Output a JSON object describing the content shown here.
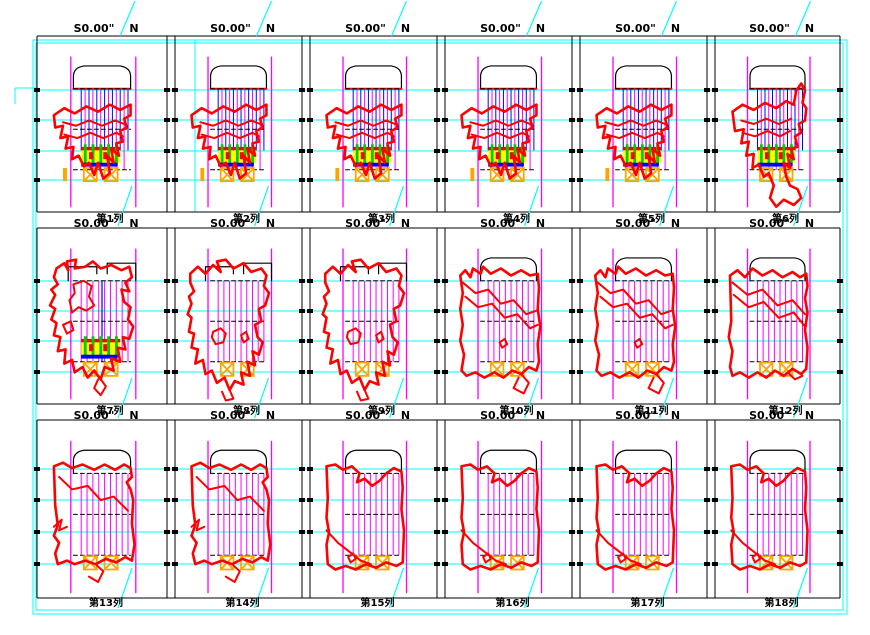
{
  "sheet": {
    "type": "CAD column section sheet",
    "rows": 3,
    "columns_per_row": 6
  },
  "labels": {
    "elevation_s": "S0.00\"",
    "elevation_n": "N",
    "col_labels": [
      "第1列",
      "第2列",
      "第3列",
      "第4列",
      "第5列",
      "第6列",
      "第7列",
      "第8列",
      "第9列",
      "第10列",
      "第11列",
      "第12列",
      "第13列",
      "第14列",
      "第15列",
      "第16列",
      "第17列",
      "第18列"
    ]
  },
  "colors": {
    "grid_cyan": "#00ffff",
    "guide_magenta": "#ff00ff",
    "hatch_blue": "#0000ff",
    "outline_red": "#ff0000",
    "support_green": "#00cc00",
    "support_yellow": "#ffff00",
    "support_blue": "#0000ff",
    "anchor_orange": "#ffa500",
    "frame_black": "#000000",
    "text_black": "#000000"
  },
  "panels": [
    {
      "id": 1,
      "shape": "A",
      "arch": "dome",
      "hatch": "blue-magenta",
      "cluster": true,
      "stub": true
    },
    {
      "id": 2,
      "shape": "A",
      "arch": "dome",
      "hatch": "blue-magenta",
      "cluster": true,
      "stub": true
    },
    {
      "id": 3,
      "shape": "A",
      "arch": "dome",
      "hatch": "blue-magenta",
      "cluster": true,
      "stub": true
    },
    {
      "id": 4,
      "shape": "A",
      "arch": "dome",
      "hatch": "blue-magenta",
      "cluster": true,
      "stub": true
    },
    {
      "id": 5,
      "shape": "A",
      "arch": "dome",
      "hatch": "blue-magenta",
      "cluster": true,
      "stub": true
    },
    {
      "id": 6,
      "shape": "B",
      "arch": "dome",
      "hatch": "blue-magenta",
      "cluster": true,
      "stub": false
    },
    {
      "id": 7,
      "shape": "C",
      "arch": "split",
      "hatch": "magenta-blue",
      "cluster": true,
      "stub": false
    },
    {
      "id": 8,
      "shape": "D",
      "arch": "split",
      "hatch": "magenta",
      "cluster": false,
      "stub": false
    },
    {
      "id": 9,
      "shape": "D",
      "arch": "split",
      "hatch": "magenta",
      "cluster": false,
      "stub": false
    },
    {
      "id": 10,
      "shape": "E",
      "arch": "dome",
      "hatch": "magenta",
      "cluster": false,
      "stub": false
    },
    {
      "id": 11,
      "shape": "E",
      "arch": "dome",
      "hatch": "magenta",
      "cluster": false,
      "stub": false
    },
    {
      "id": 12,
      "shape": "F",
      "arch": "dome",
      "hatch": "magenta",
      "cluster": false,
      "stub": false
    },
    {
      "id": 13,
      "shape": "G",
      "arch": "dome",
      "hatch": "magenta",
      "cluster": false,
      "stub": false
    },
    {
      "id": 14,
      "shape": "G",
      "arch": "dome",
      "hatch": "magenta",
      "cluster": false,
      "stub": false
    },
    {
      "id": 15,
      "shape": "H",
      "arch": "dome",
      "hatch": "magenta",
      "cluster": false,
      "stub": false
    },
    {
      "id": 16,
      "shape": "H",
      "arch": "dome",
      "hatch": "magenta",
      "cluster": false,
      "stub": false
    },
    {
      "id": 17,
      "shape": "H",
      "arch": "dome",
      "hatch": "magenta",
      "cluster": false,
      "stub": false
    },
    {
      "id": 18,
      "shape": "H",
      "arch": "dome",
      "hatch": "magenta",
      "cluster": false,
      "stub": false
    }
  ],
  "shapes": {
    "A": {
      "outer": "M13,45 L21,41 29,44 38,40 47,43 56,39 64,42 72,39 72,45 67,47 69,52 64,54 66,60 61,61 63,68 57,64 59,72 54,68 56,78 51,81 47,72 44,79 40,72 36,74 32,68 27,70 28,63 22,64 24,57 18,58 20,51 14,52 13,45 Z",
      "inner": [
        "M20,49 L30,51 40,48 50,51 60,48 67,50",
        "M21,56 L31,58 41,55 51,58 61,55 66,57"
      ]
    },
    "B": {
      "outer": "M14,43 L22,39 31,42 40,38 49,41 57,37 63,39 65,31 69,27 72,31 70,38 73,41 72,48 67,50 69,55 64,57 66,63 61,64 63,70 58,67 60,75 55,72 57,80 60,85 66,87 69,92 63,96 55,93 49,97 44,92 47,85 43,78 39,80 35,73 30,75 31,67 25,68 27,60 21,61 23,53 16,54 14,43 Z",
      "inner": [
        "M21,48 L31,50 41,47 51,50 61,47",
        "M22,55 L32,57 42,54 52,57 60,54"
      ]
    },
    "C": {
      "outer": "M15,23 L21,20 24,24 23,19 30,18 29,23 37,22 43,19 49,23 57,21 65,24 71,22 73,28 68,31 71,36 65,35 67,42 72,45 70,52 74,56 71,63 66,62 68,69 62,68 64,76 57,74 59,81 52,79 49,86 44,81 39,85 35,79 29,82 27,75 21,77 22,69 16,70 18,62 13,61 15,54 11,52 14,46 10,44 14,38 11,35 16,32 13,28 15,23 Z",
      "inner": [
        "M28,32 L36,30 42,33 40,39 44,44 38,47 32,45 27,48 25,41 29,37 28,32 Z",
        "M20,55 L26,53 28,58 23,60 20,55 Z",
        "M49,86 L53,90 49,95 44,91 47,86"
      ]
    },
    "D": {
      "outer": "M12,26 L18,22 24,26 30,21 36,25 33,19 40,18 46,23 54,20 60,25 68,23 72,27 70,33 74,37 71,44 66,46 68,53 63,55 65,62 69,65 66,72 61,70 63,78 57,76 59,84 52,82 54,89 47,87 43,92 39,85 33,88 29,81 24,83 22,75 16,77 18,69 13,68 15,60 11,59 13,51 10,49 13,43 11,39 15,36 12,31 12,26 Z",
      "inner": [
        "M30,59 L36,57 40,60 38,65 32,66 29,62 30,59 Z",
        "M52,61 L56,59 58,63 54,65 52,61 Z",
        "M43,92 L46,97 40,98 37,93"
      ]
    },
    "E": {
      "outer": "M12,27 L16,24 20,28 22,23 28,26 30,22 36,26 44,23 52,27 60,24 67,27 73,26 74,34 73,46 75,56 73,66 74,76 72,81 66,79 60,83 53,81 46,85 39,82 31,85 24,82 17,84 13,81 15,72 12,64 14,55 12,46 14,37 12,27 Z",
      "inner": [
        "M14,31 L24,37 34,35 44,43 54,41 64,49 72,47",
        "M16,39 L26,45 37,43 47,51 57,49 67,57 73,55",
        "M43,65 L47,63 49,66 45,68 43,65 Z",
        "M60,83 L66,88 62,94 54,91 58,85"
      ]
    },
    "F": {
      "outer": "M12,27 L18,24 24,28 30,23 38,27 46,24 54,28 62,25 68,28 73,26 74,33 72,40 74,48 72,58 74,68 73,80 69,83 62,80 55,84 48,81 41,85 34,82 27,85 20,82 14,84 12,79 14,70 11,62 13,53 12,27 Z",
      "inner": [
        "M14,31 L26,38 38,35 50,44 62,41 72,49",
        "M15,38 L27,45 39,42 51,51 63,48 72,56",
        "M58,82 L64,86 70,84"
      ]
    },
    "G": {
      "outer": "M13,26 L20,24 27,27 35,25 44,28 52,25 60,28 67,25 72,27 73,32 69,35 72,39 74,45 73,58 75,70 73,79 68,77 61,80 53,78 45,81 37,79 29,81 23,79 16,81 14,75 17,69 13,65 16,59 14,48 13,26 Z",
      "inner": [
        "M17,32 L27,39 39,37 49,45 59,43 70,51",
        "M13,60 L19,56 17,62 23,60",
        "M45,81 L51,85 47,91 40,88"
      ]
    },
    "H": {
      "outer": "M13,26 L20,25 26,28 33,26 39,30 37,35 43,33 49,37 55,34 60,30 66,27 72,29 73,38 72,50 74,62 73,80 68,82 60,80 52,83 44,81 36,84 28,82 20,84 14,81 13,70 15,63 13,55 14,44 13,26 Z",
      "inner": [
        "M13,62 L22,69 31,74 40,79 48,81",
        "M30,77 L34,75 36,78 32,80 30,77 Z"
      ]
    }
  }
}
